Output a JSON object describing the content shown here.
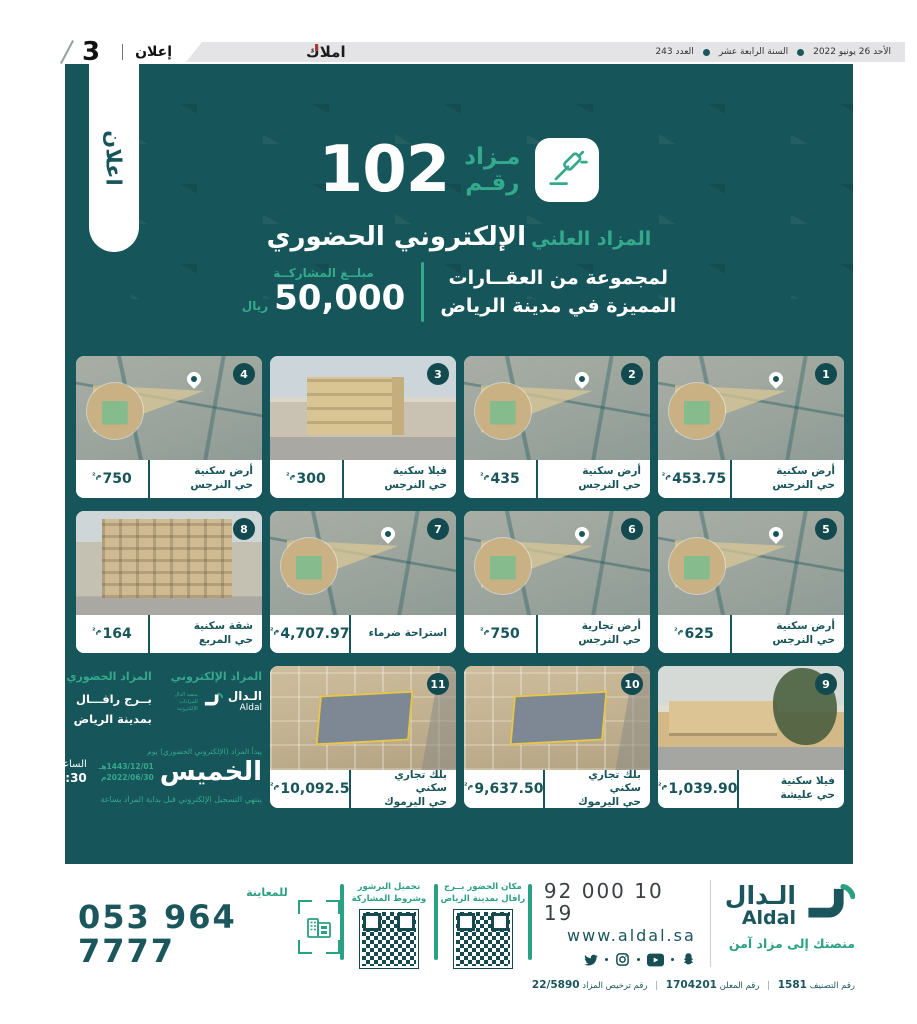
{
  "topbar": {
    "date": "الأحد 26 يونيو 2022",
    "edition": "السنة الرابعة عشر",
    "issue": "العدد 243",
    "paper_name": "املاك",
    "section_label": "إعلان",
    "page_number": "3"
  },
  "ribbon_label": "اعلان",
  "header": {
    "auction_word": "مـزاد",
    "number_label": "رقـم",
    "auction_number": "102",
    "public_label": "المزاد العلني",
    "type_label": "الإلكتروني الحضوري",
    "desc_line1": "لمجموعة من العقــارات",
    "desc_line2": "المميزة في مدينة الرياض",
    "participation_label": "مبلــغ المشاركــة",
    "participation_amount": "50,000",
    "currency": "ريال"
  },
  "cards": [
    {
      "num": "1",
      "type": "أرض سكنية",
      "district": "حي النرجس",
      "area": "453.75",
      "unit": "م²",
      "image": "map"
    },
    {
      "num": "2",
      "type": "أرض سكنية",
      "district": "حي النرجس",
      "area": "435",
      "unit": "م²",
      "image": "map"
    },
    {
      "num": "3",
      "type": "فيلا سكنية",
      "district": "حي النرجس",
      "area": "300",
      "unit": "م²",
      "image": "villa-photo"
    },
    {
      "num": "4",
      "type": "أرض سكنية",
      "district": "حي النرجس",
      "area": "750",
      "unit": "م²",
      "image": "map"
    },
    {
      "num": "5",
      "type": "أرض سكنية",
      "district": "حي النرجس",
      "area": "625",
      "unit": "م²",
      "image": "map"
    },
    {
      "num": "6",
      "type": "أرض تجارية",
      "district": "حي النرجس",
      "area": "750",
      "unit": "م²",
      "image": "map"
    },
    {
      "num": "7",
      "type": "استراحة ضرماء",
      "district": "",
      "area": "4,707.97",
      "unit": "م²",
      "image": "map"
    },
    {
      "num": "8",
      "type": "شقة سكنية",
      "district": "حي المربع",
      "area": "164",
      "unit": "م²",
      "image": "building-photo"
    },
    {
      "num": "9",
      "type": "فيلا سكنية",
      "district": "حي عليشة",
      "area": "1,039.90",
      "unit": "م²",
      "image": "house-photo"
    },
    {
      "num": "10",
      "type": "بلك تجاري سكني",
      "district": "حي اليرموك",
      "area": "9,637.50",
      "unit": "م²",
      "image": "aerial-photo"
    },
    {
      "num": "11",
      "type": "بلك تجاري سكني",
      "district": "حي اليرموك",
      "area": "10,092.5",
      "unit": "م²",
      "image": "aerial-photo"
    }
  ],
  "info_block": {
    "electronic_title": "المزاد الإلكتروني",
    "onsite_title": "المزاد الحضوري",
    "brand_ar": "الـدال",
    "brand_en": "Aldal",
    "platform_note": "منصة الدال للمزادات الإلكترونية",
    "venue_line1": "بــرج رافـــال",
    "venue_line2": "بمدينة الرياض",
    "start_note": "يبدأ المزاد (الإلكتروني الحضوري) يوم",
    "day": "الخميس",
    "date_hijri": "1443/12/01هـ",
    "date_gregorian": "2022/06/30م",
    "time_label": "الساعة",
    "time_value": "04:30م",
    "registration_note": "ينتهي التسجيل الإلكتروني قبل بداية المزاد بساعة"
  },
  "footer": {
    "brand_ar": "الـدال",
    "brand_en": "Aldal",
    "tagline": "منصتك إلى مزاد آمن",
    "phone": "92 000 10 19",
    "website": "www.aldal.sa",
    "socials": [
      "twitter",
      "instagram",
      "youtube",
      "snapchat"
    ],
    "qr_location_line1": "مكان الحضور بــرج",
    "qr_location_line2": "رافال بمدينة الرياض",
    "qr_brochure_line1": "تحميل البرشور",
    "qr_brochure_line2": "وشروط المشاركة",
    "inspection_label": "للمعاينة",
    "inspection_phone": "053 964 7777",
    "classification_label": "رقم التصنيف",
    "classification_value": "1581",
    "advertiser_label": "رقم المعلن",
    "advertiser_value": "1704201",
    "license_label": "رقم ترخيص المزاد",
    "license_value": "22/5890",
    "separator": "|"
  },
  "icons": {
    "header_icon": "gavel",
    "card_pin_icon": "location-pin",
    "brand_icon": "aldal-mark",
    "inspection_icon": "building-scan",
    "qr_icon": "qr-code"
  },
  "colors": {
    "panel_teal": "#16555a",
    "accent_green": "#35a98c",
    "brand_teal": "#1a565c",
    "badge_teal": "#134a50",
    "topbar_gray": "#e4e4e6",
    "highlight_red": "#b23a36"
  }
}
